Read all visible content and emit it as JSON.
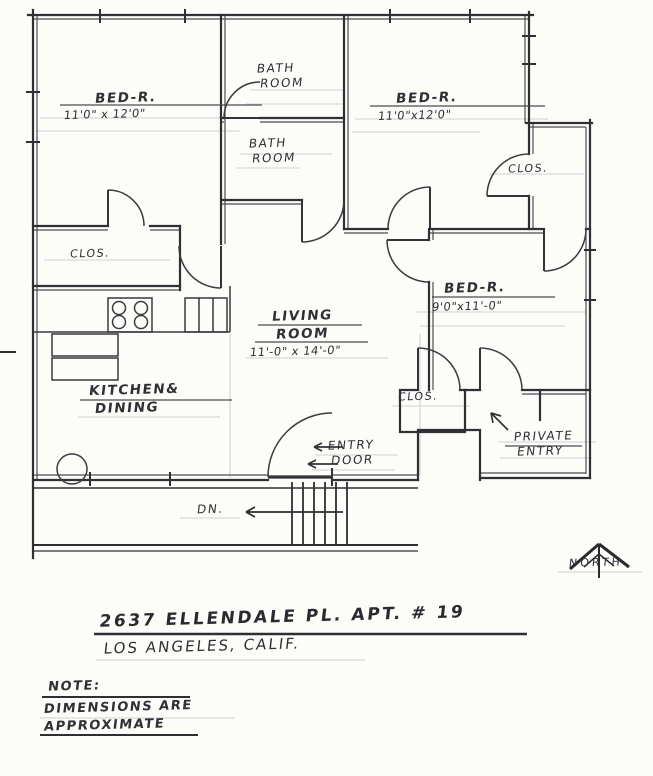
{
  "page": {
    "description": "Hand-drawn apartment floor plan sketch",
    "paper_color": "#fcfcf9",
    "ink_color": "#2f2f34",
    "pencil_color": "#b4b4bc"
  },
  "rooms": {
    "bedroom_top_left": {
      "name": "BED-R.",
      "dims": "11'0\" x 12'0\""
    },
    "bathroom_top": {
      "line1": "BATH",
      "line2": "ROOM"
    },
    "bedroom_top_right": {
      "name": "BED-R.",
      "dims": "11'0\"x12'0\""
    },
    "bathroom_mid": {
      "line1": "BATH",
      "line2": "ROOM"
    },
    "closet_right": {
      "name": "CLOS."
    },
    "closet_left": {
      "name": "CLOS."
    },
    "bedroom_right": {
      "name": "BED-R.",
      "dims": "9'0\"x11'-0\""
    },
    "living_room": {
      "line1": "LIVING",
      "line2": "ROOM",
      "dims": "11'-0\" x 14'-0\""
    },
    "kitchen": {
      "line1": "KITCHEN&",
      "line2": "DINING"
    },
    "closet_mid": {
      "name": "CLOS."
    },
    "entry": {
      "line1": "ENTRY",
      "line2": "DOOR"
    },
    "private_entry": {
      "line1": "PRIVATE",
      "line2": "ENTRY"
    },
    "stairs": {
      "label": "DN."
    },
    "compass": {
      "label": "NORTH"
    }
  },
  "title_block": {
    "address_line1": "2637 ELLENDALE PL. APT. # 19",
    "address_line2": "LOS ANGELES, CALIF."
  },
  "note": {
    "heading": "NOTE:",
    "line1": "DIMENSIONS ARE",
    "line2": "APPROXIMATE"
  }
}
